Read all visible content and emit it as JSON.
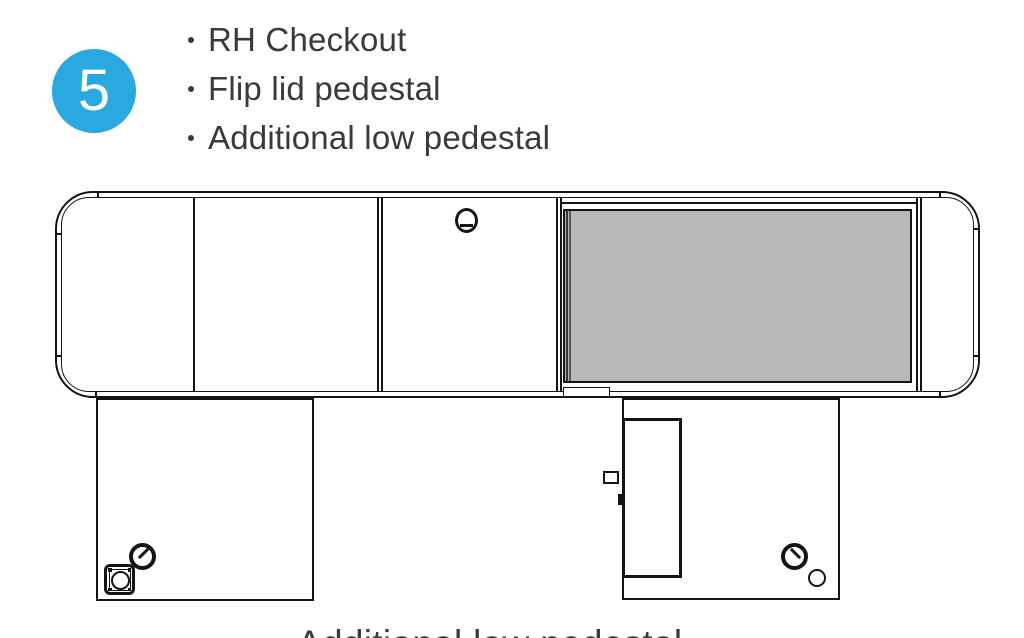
{
  "header": {
    "step_number": "5",
    "bullets": [
      "RH Checkout",
      "Flip lid pedestal",
      "Additional low pedestal"
    ]
  },
  "diagram": {
    "caption": "Additional low pedestal",
    "components": [
      "checkout-counter-plan-view",
      "left-rounded-end-cap",
      "left-cabinet-section",
      "middle-section-with-grommet",
      "belt-flip-lid-area",
      "right-rounded-end-cap",
      "left-low-pedestal",
      "right-pedestal-with-door",
      "cable-grommets",
      "power-outlet"
    ]
  },
  "colors": {
    "badge_blue": "#29a9e0",
    "belt_gray": "#b9b9b9",
    "line": "#141414",
    "text": "#3a3a3a"
  }
}
